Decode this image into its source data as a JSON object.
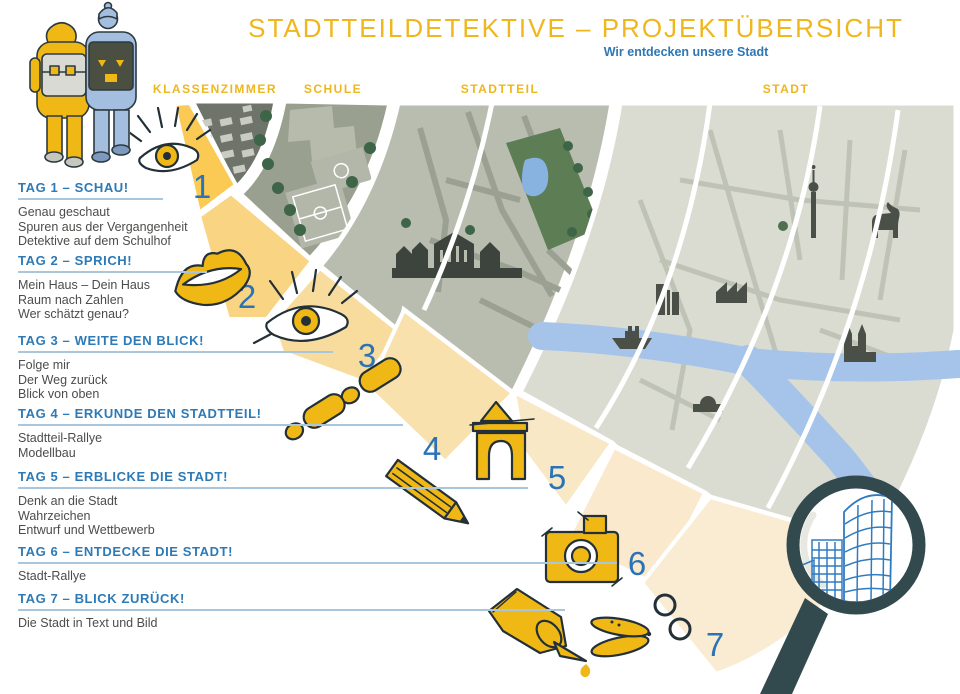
{
  "poster": {
    "title": "STADTTEILDETEKTIVE – PROJEKTÜBERSICHT",
    "subtitle": "Wir entdecken unsere Stadt"
  },
  "zones": [
    {
      "label": "KLASSENZIMMER"
    },
    {
      "label": "SCHULE"
    },
    {
      "label": "STADTTEIL"
    },
    {
      "label": "STADT"
    }
  ],
  "days": [
    {
      "number": "1",
      "heading": "TAG 1 – SCHAU!",
      "icon": "eye",
      "items": [
        "Genau geschaut",
        "Spuren aus der Vergangenheit",
        "Detektive auf dem Schulhof"
      ]
    },
    {
      "number": "2",
      "heading": "TAG 2 – SPRICH!",
      "icon": "lips",
      "items": [
        "Mein Haus – Dein Haus",
        "Raum nach Zahlen",
        "Wer schätzt genau?"
      ]
    },
    {
      "number": "3",
      "heading": "TAG 3 – WEITE DEN BLICK!",
      "icon": "open-eye",
      "items": [
        "Folge mir",
        "Der Weg zurück",
        "Blick von oben"
      ]
    },
    {
      "number": "4",
      "heading": "TAG 4 – ERKUNDE DEN STADTTEIL!",
      "icon": "footprints",
      "items": [
        "Stadtteil-Rallye",
        "Modellbau"
      ]
    },
    {
      "number": "5",
      "heading": "TAG 5 – ERBLICKE DIE STADT!",
      "icon": "arch-and-pencil",
      "items": [
        "Denk an die Stadt",
        "Wahrzeichen",
        "Entwurf und Wettbewerb"
      ]
    },
    {
      "number": "6",
      "heading": "TAG 6 – ENTDECKE DIE STADT!",
      "icon": "camera",
      "items": [
        "Stadt-Rallye"
      ]
    },
    {
      "number": "7",
      "heading": "TAG 7 – BLICK ZURÜCK!",
      "icon": "glue-and-scissors",
      "items": [
        "Die Stadt in Text und Bild"
      ]
    }
  ],
  "colors": {
    "accent_yellow": "#eeb71c",
    "icon_yellow": "#f0b814",
    "heading_blue": "#2d7ab6",
    "number_blue": "#2a73b7",
    "magnifier_dark": "#32494e",
    "sketch_blue": "#2f7bc1"
  }
}
